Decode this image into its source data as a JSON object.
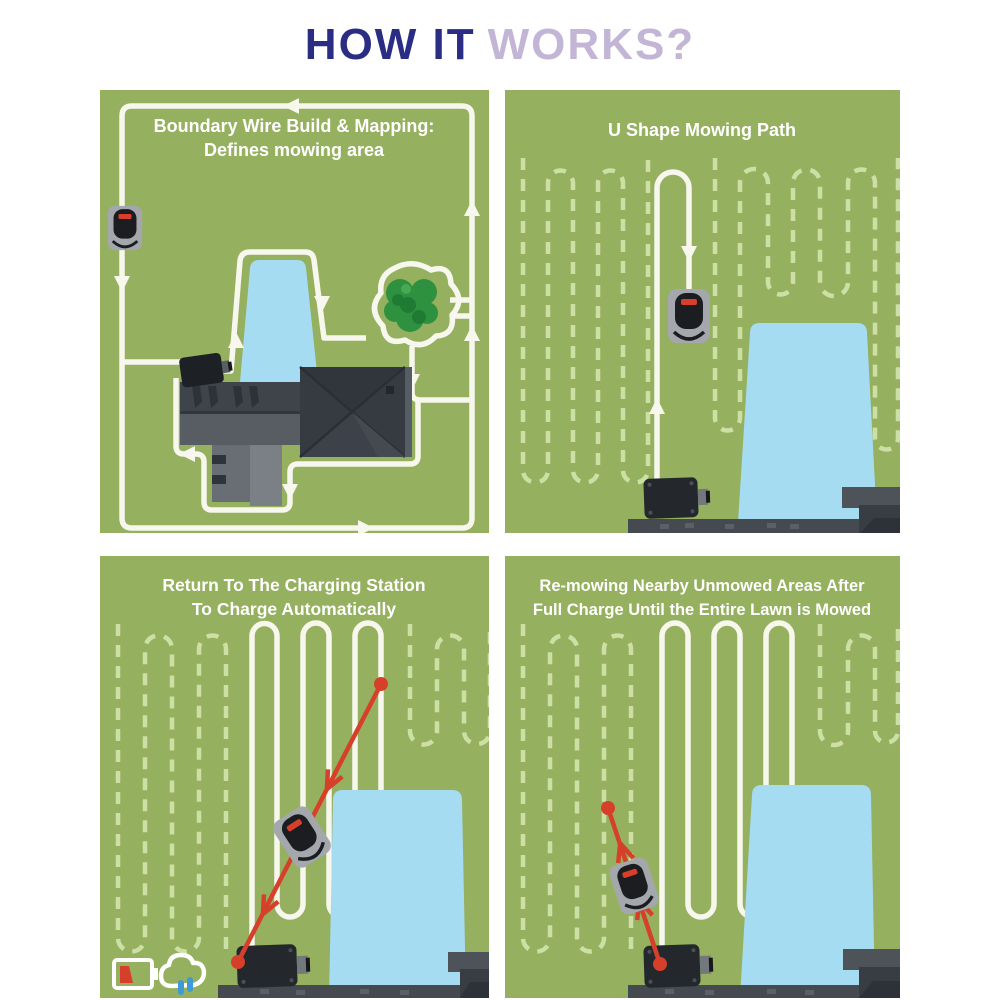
{
  "header": {
    "title_accent": "HOW IT",
    "title_rest": "WORKS?"
  },
  "panels": {
    "boundary": {
      "title_line1": "Boundary Wire Build & Mapping:",
      "title_line2": "Defines mowing area"
    },
    "ushape": {
      "title": "U Shape Mowing Path"
    },
    "return_station": {
      "title_line1": "Return To The Charging Station",
      "title_line2": "To Charge Automatically"
    },
    "remow": {
      "title_line1": "Re-mowing Nearby Unmowed Areas After",
      "title_line2": "Full Charge Until the Entire Lawn is Mowed"
    }
  },
  "icons": {
    "mower": "robot-mower-icon",
    "station": "charging-station-icon",
    "battery": "battery-low-icon",
    "rain": "rain-cloud-icon"
  },
  "colors": {
    "title_navy": "#2b2d85",
    "title_purple": "#c3b5d6",
    "grass": "#95b05e",
    "path_white": "#f7f7ee",
    "dash_green": "#cddfa5",
    "pool_blue": "#a6dcf2",
    "route_red": "#d6402a",
    "roof_dark": "#363b42",
    "station_dark": "#24282d"
  }
}
